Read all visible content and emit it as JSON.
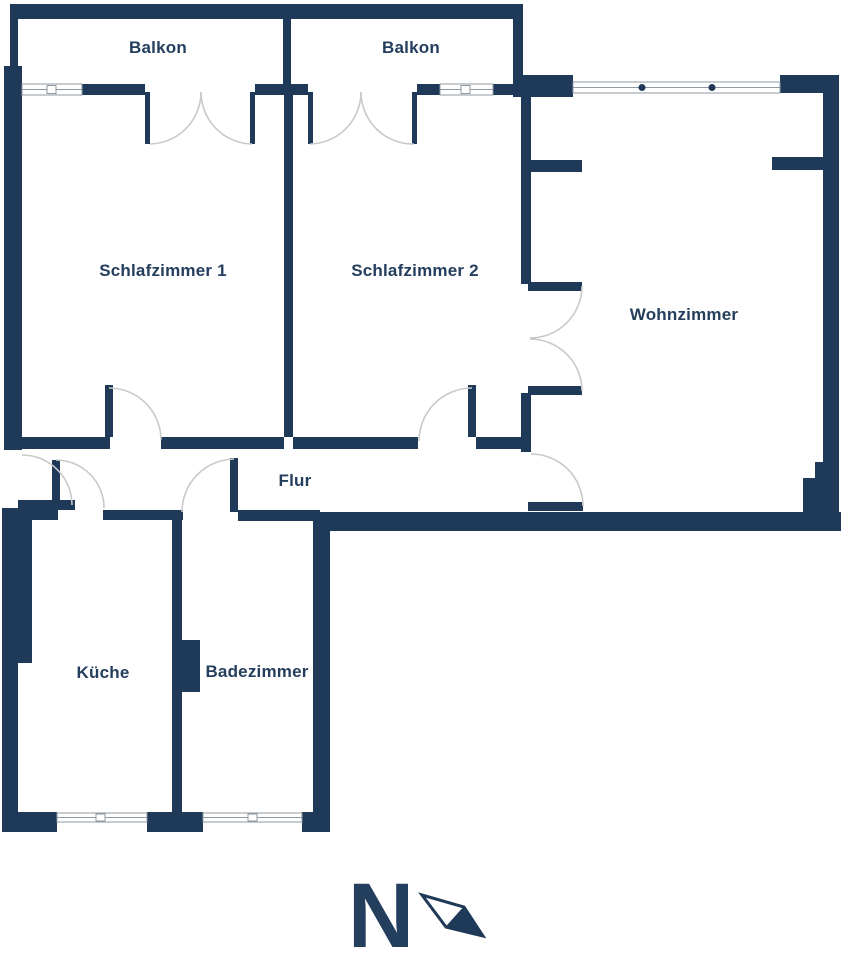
{
  "plan": {
    "title": "Apartment floor plan",
    "rooms": [
      {
        "id": "balkon-1",
        "label": "Balkon"
      },
      {
        "id": "balkon-2",
        "label": "Balkon"
      },
      {
        "id": "schlafzimmer-1",
        "label": "Schlafzimmer 1"
      },
      {
        "id": "schlafzimmer-2",
        "label": "Schlafzimmer 2"
      },
      {
        "id": "wohnzimmer",
        "label": "Wohnzimmer"
      },
      {
        "id": "flur",
        "label": "Flur"
      },
      {
        "id": "kueche",
        "label": "Küche"
      },
      {
        "id": "badezimmer",
        "label": "Badezimmer"
      }
    ],
    "compass": {
      "label": "N"
    },
    "colors": {
      "wall": "#1f3a58",
      "text": "#243e5d",
      "door_arc": "#c9c9c9",
      "window_line": "#8e98a2",
      "background": "#ffffff"
    }
  }
}
